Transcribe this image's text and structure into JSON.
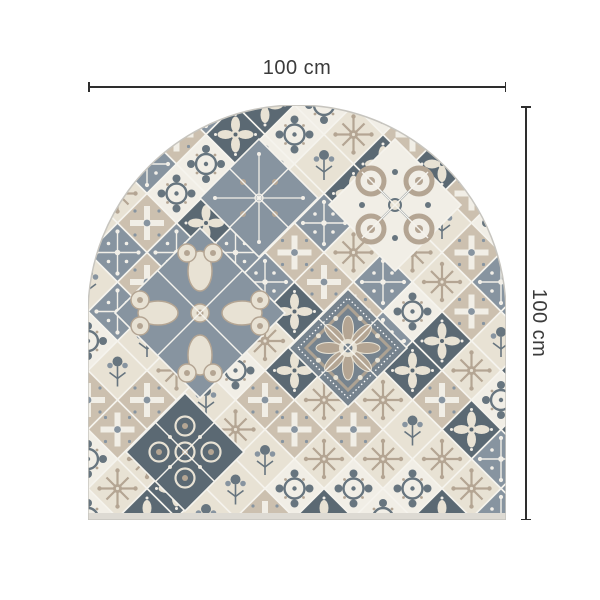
{
  "dimensions": {
    "width": {
      "label": "100 cm"
    },
    "height": {
      "label": "100 cm"
    }
  },
  "colors": {
    "background": "#ffffff",
    "dim_line": "#2e2e2e",
    "dim_text": "#3b3b3b",
    "grout": "#f5f3ed",
    "cream": "#e8e2d4",
    "offwhite": "#f1eee6",
    "slate": "#8794a0",
    "slate_mid": "#76838e",
    "slate_dark": "#67757f",
    "slate_deep": "#5b6973",
    "taupe": "#b4a593",
    "taupe_light": "#ccc0af",
    "edge": "#dddad3",
    "outline": "#c7c5bf"
  }
}
